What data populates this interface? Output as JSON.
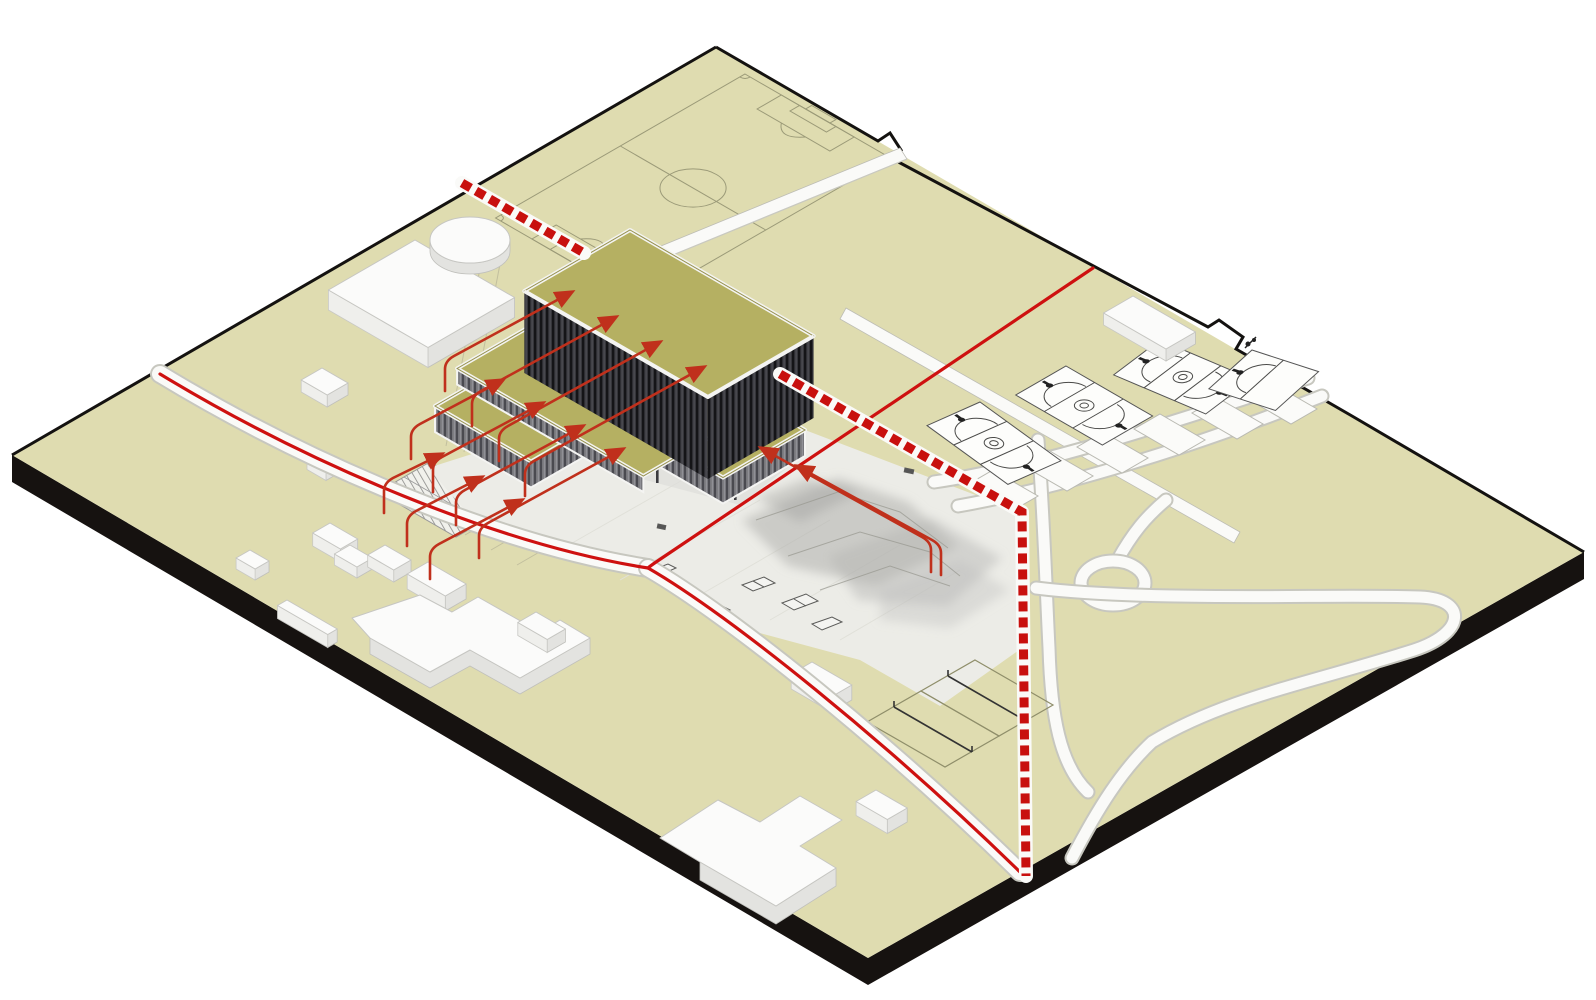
{
  "colors": {
    "background": "#ffffff",
    "ground": "#dfdcb0",
    "site_edge": "#161210",
    "field_line": "#9b9a78",
    "roof": "#b5b062",
    "facade_dark_a": "#35353a",
    "facade_dark_b": "#141417",
    "facade_mid_a": "#77777c",
    "facade_mid_b": "#4a4a50",
    "parapet": "#f4f4f2",
    "white_surface": "#fafaf8",
    "path_casing": "#c7c7bf",
    "plaza": "#ecece7",
    "mound": "#a8a8a5",
    "red_route": "#ce1110",
    "red_crossing": "#c8100e",
    "red_arrow": "#c0301c",
    "court_line": "#4a4a48",
    "building_white_top": "#fbfbfa",
    "building_white_side": "#e3e3e0",
    "hatch_line": "#8a8a88"
  }
}
